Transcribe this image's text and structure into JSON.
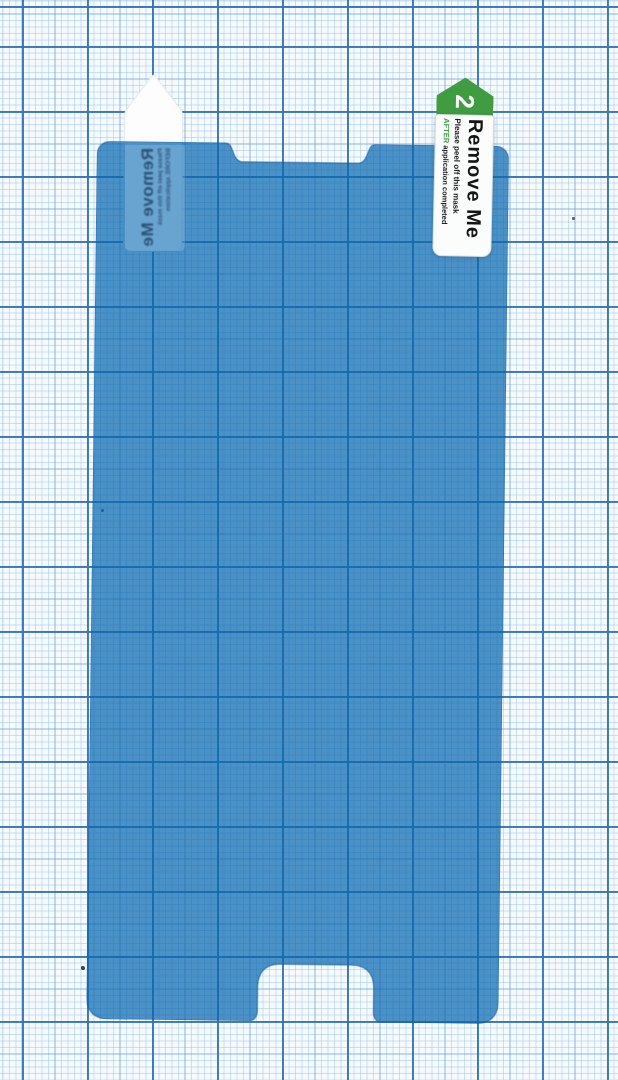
{
  "scene": {
    "description": "Blue phone screen-protector film with peel tabs lying on millimeter graph paper",
    "paper": {
      "base_color": "#f6fafd",
      "fine_line_color": "#a3c9e9",
      "medium_line_color": "#689ed0",
      "major_line_color": "#3474b6"
    },
    "film": {
      "color": "#0868b0",
      "opacity": 0.72,
      "edge_color": "#155a92"
    }
  },
  "tab2": {
    "step_number": "2",
    "arrow_color": "#3f9c41",
    "title": "Remove Me",
    "instruction_line": "Please peel off this mask",
    "highlight_word": "AFTER",
    "highlight_rest": " application completed"
  },
  "tab1": {
    "title": "Remove Me",
    "instruction_line": "Please peel off this mask",
    "instruction_line2": "BEFORE application"
  }
}
